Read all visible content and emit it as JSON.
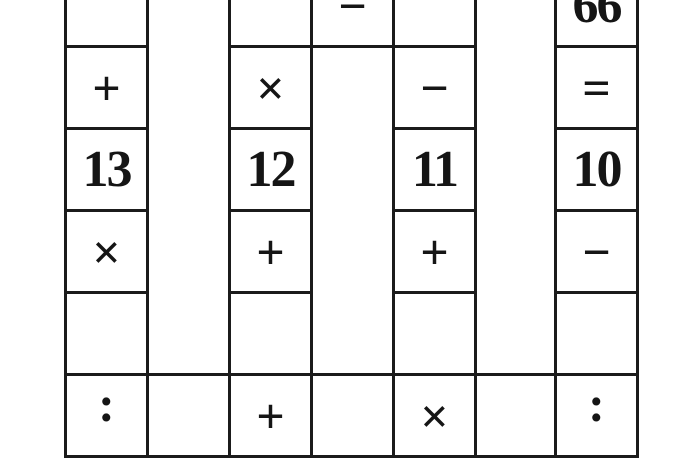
{
  "puzzle": {
    "kind": "arithmetic-cross-number-grid",
    "colors": {
      "background": "#ffffff",
      "grid_line": "#1b1b1b",
      "text": "#151515"
    },
    "cells": [
      {
        "col": 0,
        "row": 0,
        "value": "",
        "kind": "empty"
      },
      {
        "col": 2,
        "row": 0,
        "value": "",
        "kind": "empty"
      },
      {
        "col": 3,
        "row": 0,
        "value": "−",
        "kind": "operator",
        "name": "minus"
      },
      {
        "col": 4,
        "row": 0,
        "value": "",
        "kind": "empty"
      },
      {
        "col": 6,
        "row": 0,
        "value": "66",
        "kind": "number"
      },
      {
        "col": 0,
        "row": 1,
        "value": "+",
        "kind": "operator",
        "name": "plus"
      },
      {
        "col": 2,
        "row": 1,
        "value": "×",
        "kind": "operator",
        "name": "times"
      },
      {
        "col": 4,
        "row": 1,
        "value": "−",
        "kind": "operator",
        "name": "minus"
      },
      {
        "col": 6,
        "row": 1,
        "value": "=",
        "kind": "operator",
        "name": "equals"
      },
      {
        "col": 0,
        "row": 2,
        "value": "13",
        "kind": "number"
      },
      {
        "col": 2,
        "row": 2,
        "value": "12",
        "kind": "number"
      },
      {
        "col": 4,
        "row": 2,
        "value": "11",
        "kind": "number"
      },
      {
        "col": 6,
        "row": 2,
        "value": "10",
        "kind": "number"
      },
      {
        "col": 0,
        "row": 3,
        "value": "×",
        "kind": "operator",
        "name": "times"
      },
      {
        "col": 2,
        "row": 3,
        "value": "+",
        "kind": "operator",
        "name": "plus"
      },
      {
        "col": 4,
        "row": 3,
        "value": "+",
        "kind": "operator",
        "name": "plus"
      },
      {
        "col": 6,
        "row": 3,
        "value": "−",
        "kind": "operator",
        "name": "minus"
      },
      {
        "col": 0,
        "row": 4,
        "value": "",
        "kind": "empty"
      },
      {
        "col": 2,
        "row": 4,
        "value": "",
        "kind": "empty"
      },
      {
        "col": 4,
        "row": 4,
        "value": "",
        "kind": "empty"
      },
      {
        "col": 6,
        "row": 4,
        "value": "",
        "kind": "empty"
      },
      {
        "col": 0,
        "row": 5,
        "value": ":",
        "kind": "operator",
        "name": "divide-colon"
      },
      {
        "col": 1,
        "row": 5,
        "value": "",
        "kind": "empty"
      },
      {
        "col": 2,
        "row": 5,
        "value": "+",
        "kind": "operator",
        "name": "plus"
      },
      {
        "col": 3,
        "row": 5,
        "value": "",
        "kind": "empty"
      },
      {
        "col": 4,
        "row": 5,
        "value": "×",
        "kind": "operator",
        "name": "times"
      },
      {
        "col": 5,
        "row": 5,
        "value": "",
        "kind": "empty"
      },
      {
        "col": 6,
        "row": 5,
        "value": ":",
        "kind": "operator",
        "name": "divide-colon"
      }
    ]
  }
}
